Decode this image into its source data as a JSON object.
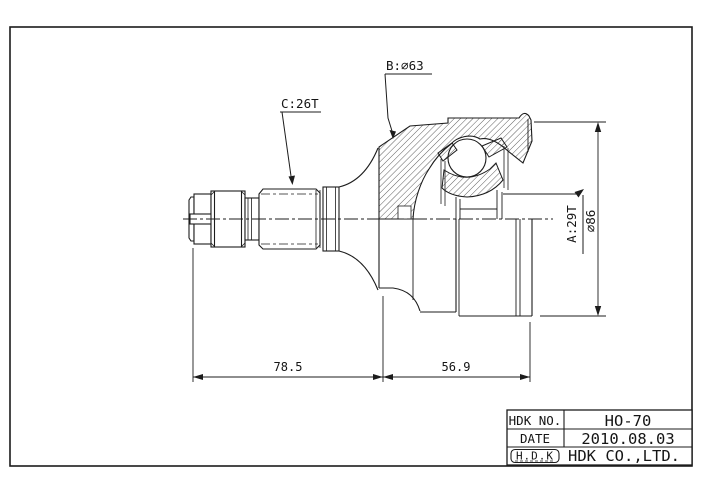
{
  "page": {
    "background": "#ffffff",
    "line_color": "#1c1c1c"
  },
  "drawing": {
    "label_b": "B:∅63",
    "label_c": "C:26T",
    "label_a": "A:29T",
    "label_dia": "∅86",
    "dim_left": "78.5",
    "dim_right": "56.9"
  },
  "title_block": {
    "rows": [
      {
        "label": "HDK NO.",
        "value": "HO-70"
      },
      {
        "label": "DATE",
        "value": "2010.08.03"
      },
      {
        "label": "H.D.K",
        "value": "HDK CO.,LTD."
      }
    ]
  }
}
